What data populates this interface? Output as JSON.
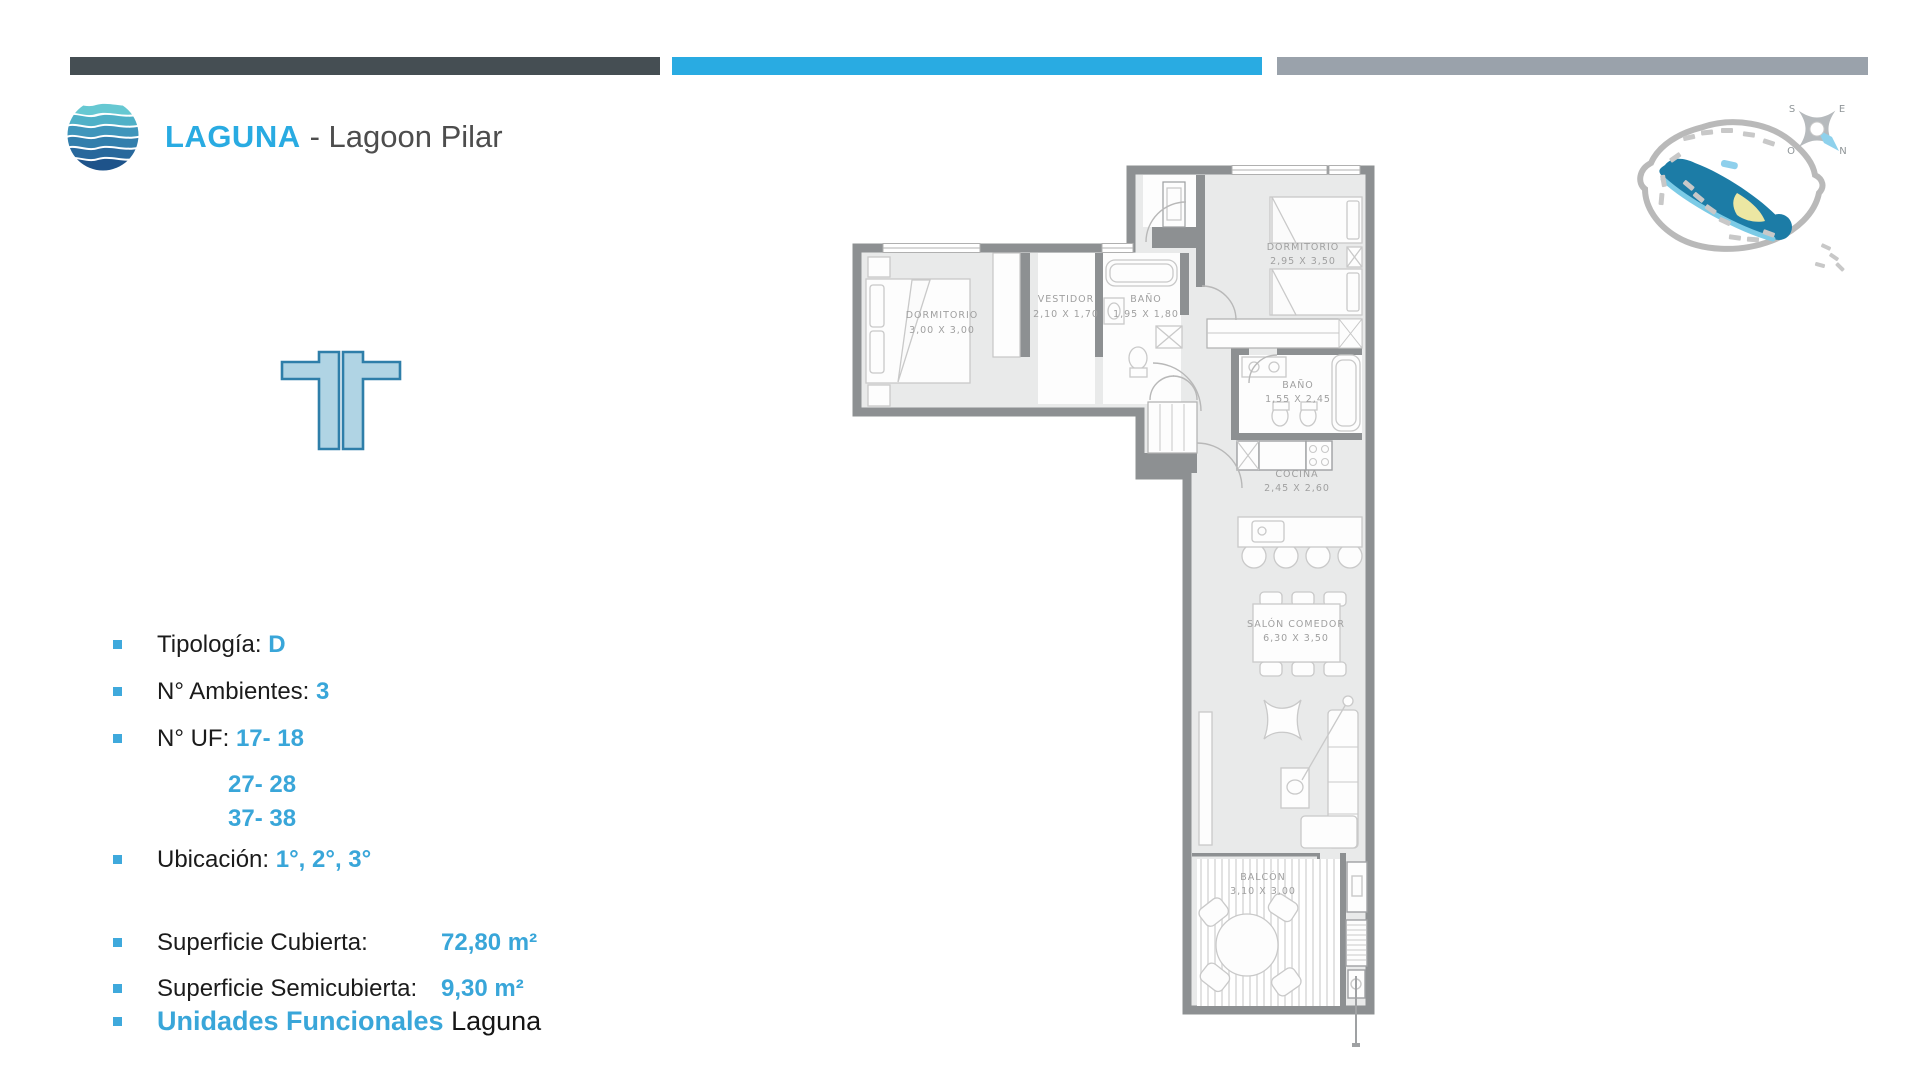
{
  "header": {
    "brand": "LAGUNA",
    "project": "- Lagoon Pilar"
  },
  "details": {
    "items": [
      {
        "label": "Tipología: ",
        "value": "D"
      },
      {
        "label": "N° Ambientes: ",
        "value": "3"
      },
      {
        "label": "N° UF: ",
        "value": "17- 18"
      },
      {
        "label": "",
        "value": "27- 28"
      },
      {
        "label": "",
        "value": "37- 38"
      },
      {
        "label": "Ubicación: ",
        "value": "1°, 2°, 3°"
      }
    ]
  },
  "surfaces": {
    "items": [
      {
        "label": "Superficie Cubierta:",
        "value": "72,80 m²"
      },
      {
        "label": "Superficie Semicubierta: ",
        "value": "9,30 m²"
      }
    ]
  },
  "functional_units": {
    "highlight": "Unidades Funcionales",
    "suffix": " Laguna"
  },
  "floorplan": {
    "rooms": [
      {
        "name": "DORMITORIO",
        "dims": "3,00 X 3,00"
      },
      {
        "name": "VESTIDOR",
        "dims": "2,10 X 1,70"
      },
      {
        "name": "BAÑO",
        "dims": "1,95 X 1,80"
      },
      {
        "name": "DORMITORIO",
        "dims": "2,95 X 3,50"
      },
      {
        "name": "BAÑO",
        "dims": "1,55 X 2,45"
      },
      {
        "name": "COCINA",
        "dims": "2,45 X 2,60"
      },
      {
        "name": "SALÓN COMEDOR",
        "dims": "6,30 X 3,50"
      },
      {
        "name": "BALCÓN",
        "dims": "3,10 X 3,00"
      }
    ]
  },
  "site_map": {
    "compass": {
      "top_left": "S",
      "top_right": "E",
      "bottom_left": "O",
      "bottom_right": "N"
    }
  },
  "colors": {
    "accent_bar": "#29abe2",
    "dark_bar": "#454e53",
    "gray_bar": "#9aa2ab",
    "value_text": "#39a6d9",
    "wall": "#8d9092",
    "floor": "#e9eaea",
    "lagoon": "#1c7ca6"
  }
}
